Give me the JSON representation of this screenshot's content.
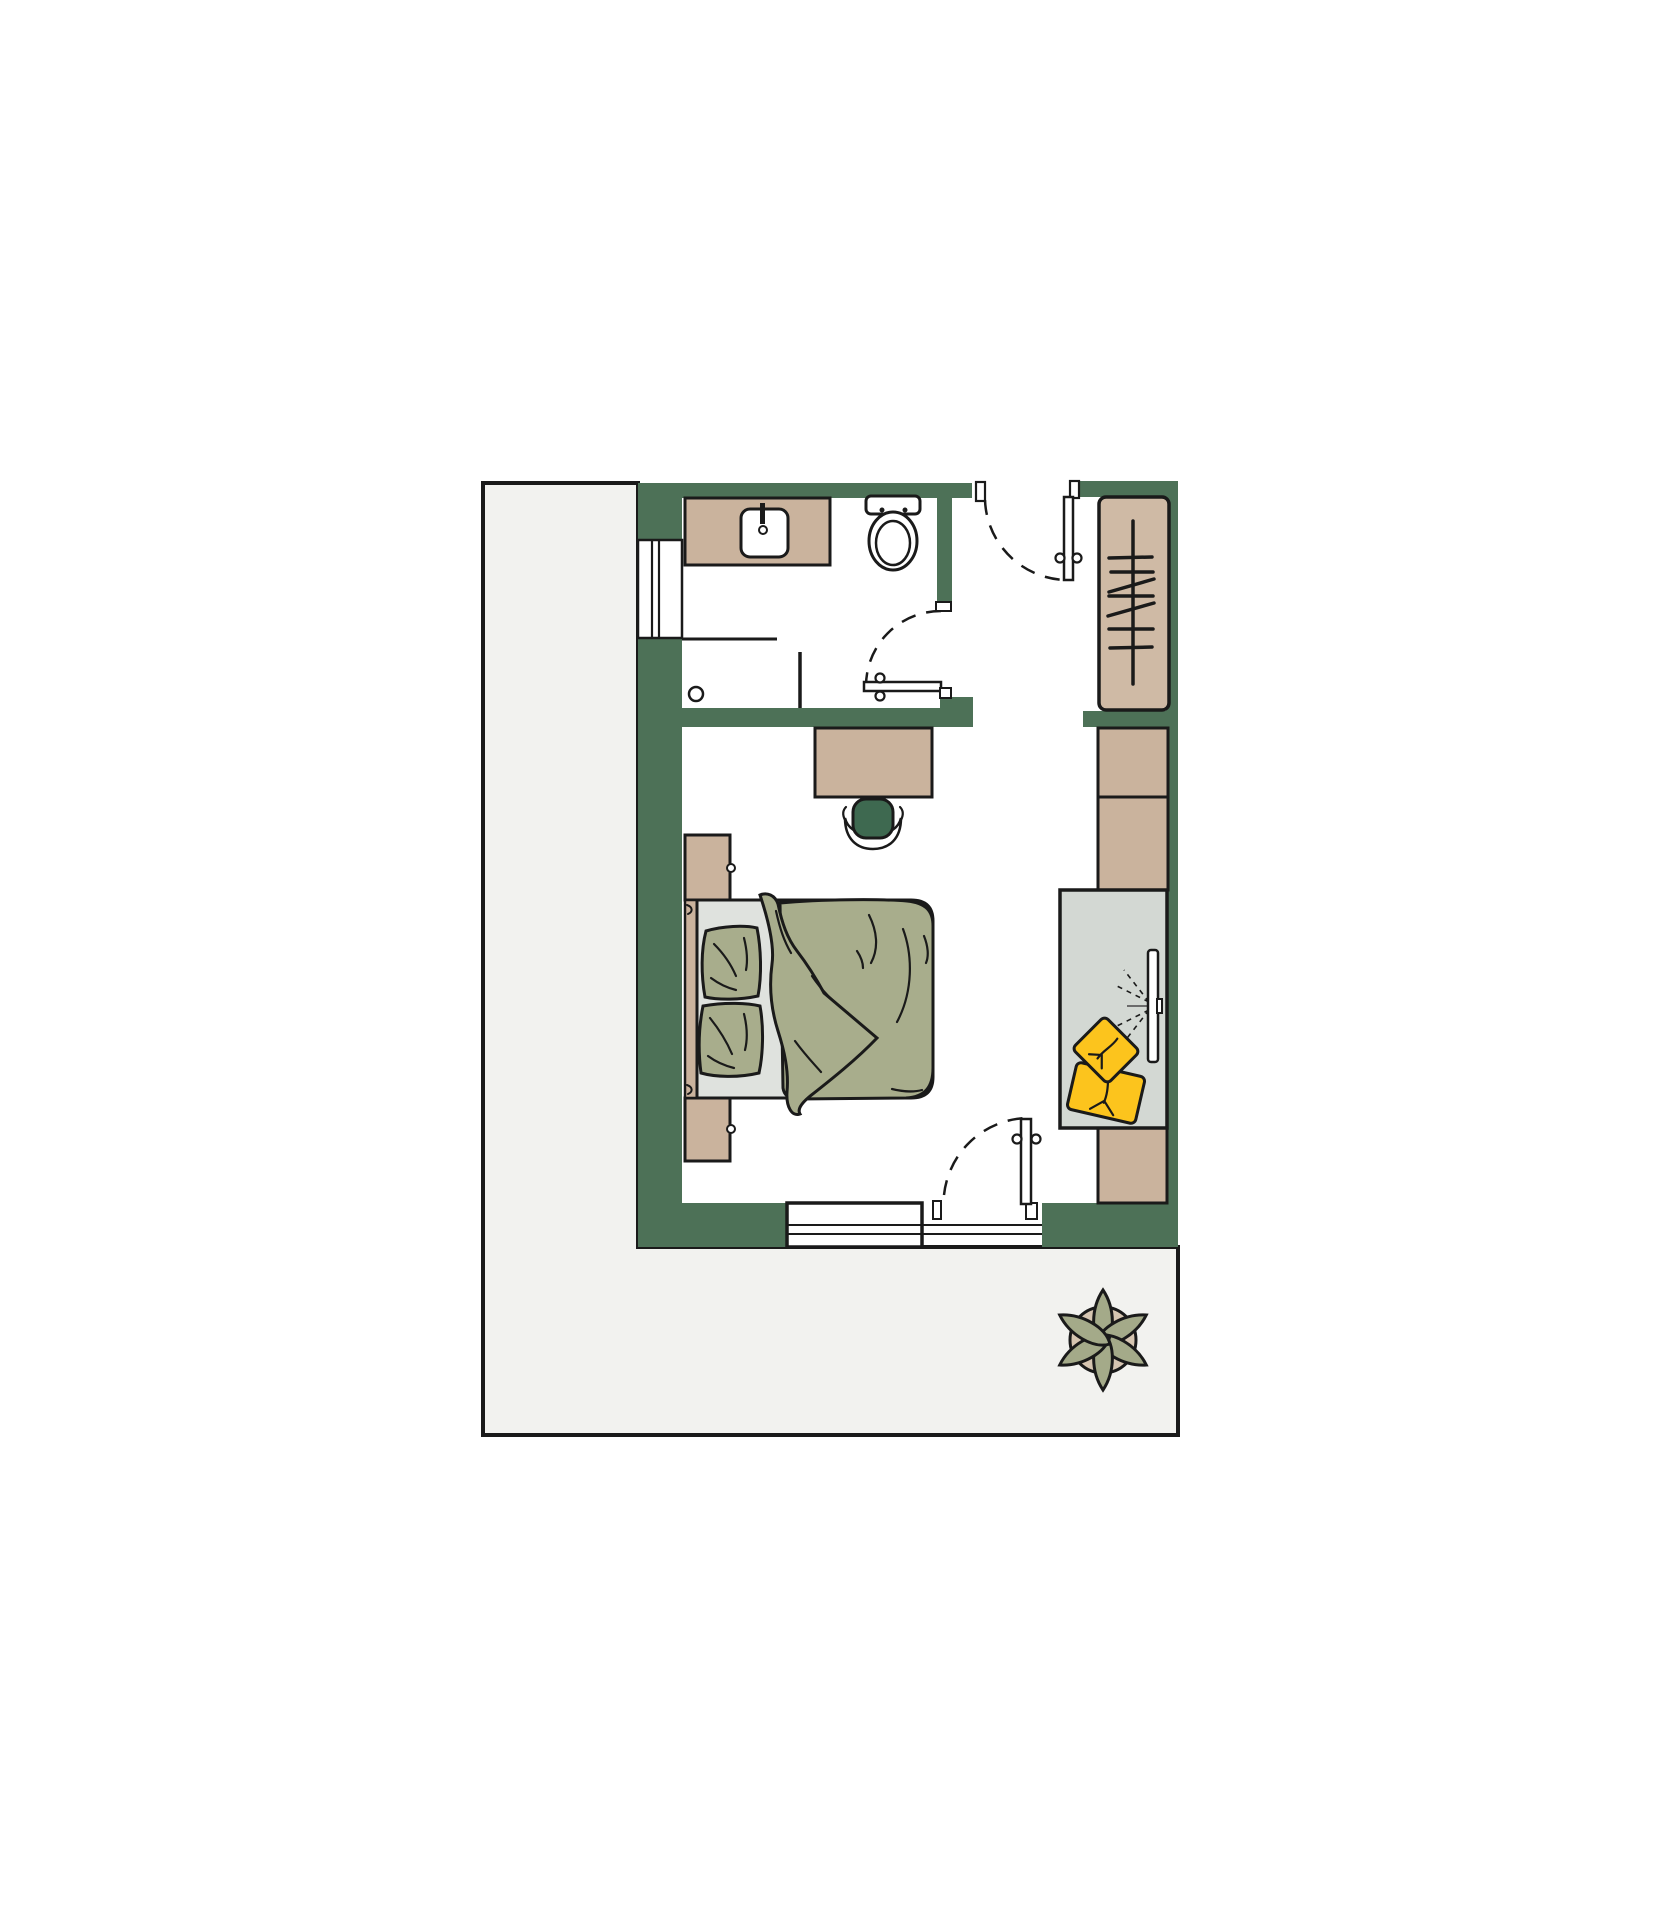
{
  "scene": {
    "type": "floor-plan",
    "view": "top-down",
    "rooms": [
      "terrace",
      "bathroom",
      "entry-hall",
      "bedroom"
    ],
    "furniture": {
      "bathroom": [
        "vanity-counter",
        "sink-basin",
        "faucet",
        "toilet",
        "shower-screen",
        "shower-drain",
        "radiator",
        "hinged-door"
      ],
      "entry-hall": [
        "entry-door",
        "open-wardrobe-with-hangers"
      ],
      "bedroom": [
        "desk",
        "desk-chair",
        "double-bed",
        "two-pillows",
        "duvet",
        "nightstand-top",
        "nightstand-bottom",
        "wall-cabinets",
        "sideboard",
        "wall-mounted-tv",
        "two-yellow-cushions",
        "window",
        "balcony-door"
      ],
      "terrace": [
        "potted-plant"
      ]
    }
  },
  "colors": {
    "background": "#ffffff",
    "terrace_floor": "#f2f2ef",
    "wall": "#4d7157",
    "wood": "#cab39d",
    "wood_light": "#cfbaa5",
    "textile": "#a8ad8c",
    "mattress": "#dfe2de",
    "sideboard": "#d3d8d3",
    "cushion_yellow": "#fcc41d",
    "chair": "#3e6950",
    "plant_leaf": "#a4aa89",
    "plant_pot": "#d6c5b1",
    "tv_signal": "#6b6b6b",
    "outline": "#1a1a1a"
  }
}
